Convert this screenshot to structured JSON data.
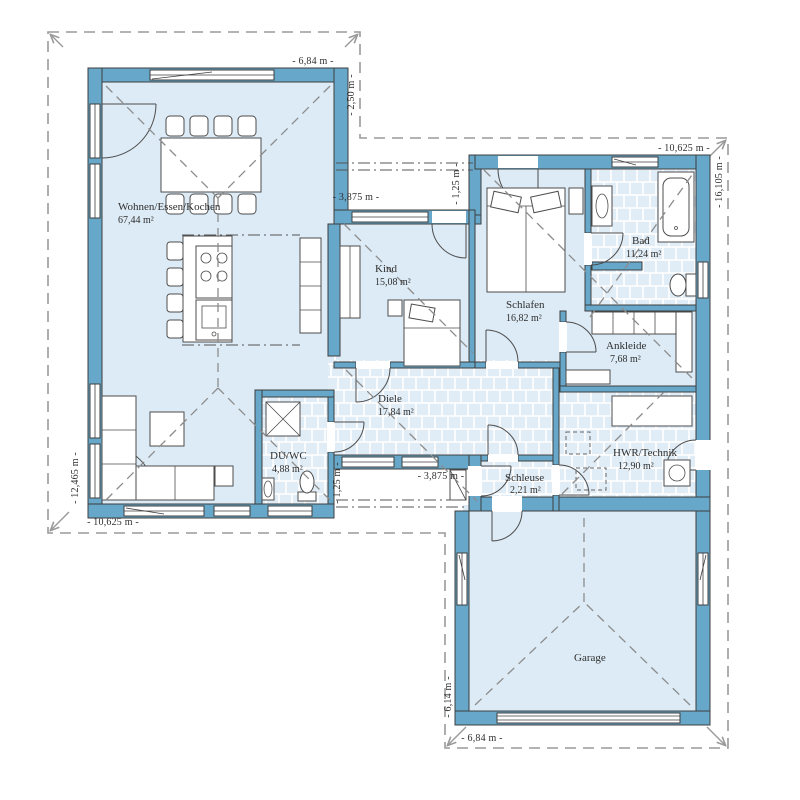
{
  "rooms": [
    {
      "id": "wohnen",
      "name": "Wohnen/Essen/Kochen",
      "area": "67,44 m²"
    },
    {
      "id": "kind",
      "name": "Kind",
      "area": "15,08 m²"
    },
    {
      "id": "schlafen",
      "name": "Schlafen",
      "area": "16,82 m²"
    },
    {
      "id": "bad",
      "name": "Bad",
      "area": "11,24 m²"
    },
    {
      "id": "ankleide",
      "name": "Ankleide",
      "area": "7,68 m²"
    },
    {
      "id": "diele",
      "name": "Diele",
      "area": "17,84 m²"
    },
    {
      "id": "duwc",
      "name": "DU/WC",
      "area": "4,88 m²"
    },
    {
      "id": "hwr",
      "name": "HWR/Technik",
      "area": "12,90 m²"
    },
    {
      "id": "schleuse",
      "name": "Schleuse",
      "area": "2,21 m²"
    },
    {
      "id": "garage",
      "name": "Garage",
      "area": ""
    }
  ],
  "dimensions": [
    {
      "id": "top-left-width",
      "label": "- 6,84 m -"
    },
    {
      "id": "top-left-height",
      "label": "- 2,50 m -"
    },
    {
      "id": "top-right-width",
      "label": "- 10,625 m -"
    },
    {
      "id": "right-height",
      "label": "- 16,105 m -"
    },
    {
      "id": "porch-top-width",
      "label": "- 3,875 m -"
    },
    {
      "id": "porch-top-height",
      "label": "- 1,25 m -"
    },
    {
      "id": "left-height",
      "label": "- 12,465 m -"
    },
    {
      "id": "bottom-left-width",
      "label": "- 10,625 m -"
    },
    {
      "id": "porch-bottom-width",
      "label": "- 3,875 m -"
    },
    {
      "id": "porch-bottom-height",
      "label": "- 1,25 m -"
    },
    {
      "id": "garage-height",
      "label": "- 6,14 m -"
    },
    {
      "id": "garage-width",
      "label": "- 6,84 m -"
    }
  ],
  "colors": {
    "wall": "#66a7ca",
    "floor": "#dcebf5",
    "tile_base": "#e1edf6",
    "tile_grout": "#ffffff",
    "roof_dash": "#9a9a9a",
    "text": "#2f2f2f",
    "outline": "#3f3f3f"
  }
}
